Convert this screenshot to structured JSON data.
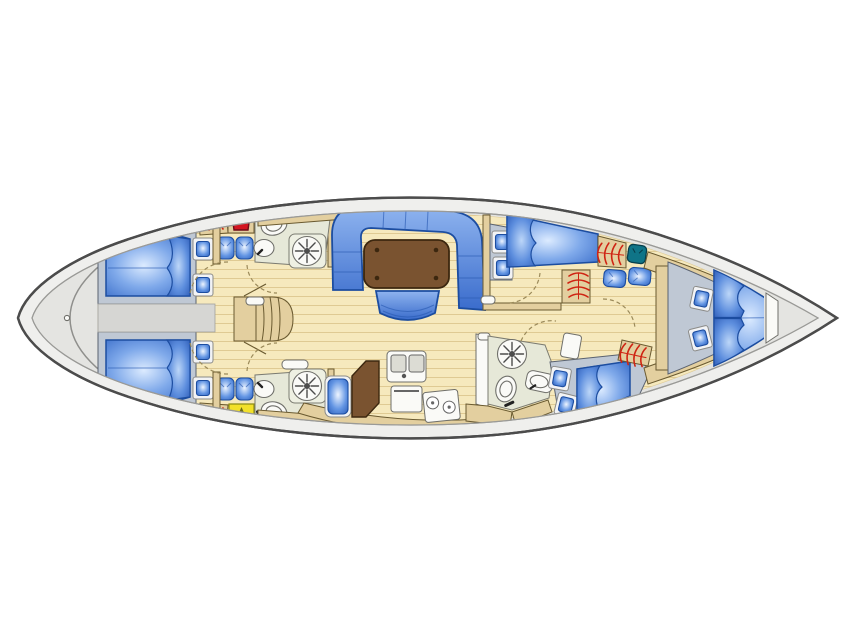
{
  "diagram": {
    "type": "sailing-yacht-interior-floor-plan",
    "orientation": {
      "bow": "right",
      "stern": "left",
      "port_side": "top",
      "starboard_side": "bottom"
    },
    "regions": [
      {
        "name": "transom"
      },
      {
        "name": "aft-cabin-port",
        "features": [
          "double-berth",
          "pillow",
          "hatch-windows",
          "seat-cushions",
          "hanging-locker",
          "wet-gear-locker"
        ]
      },
      {
        "name": "aft-cabin-starboard",
        "features": [
          "double-berth",
          "pillow",
          "hatch-windows",
          "seat-cushions",
          "hanging-locker",
          "yellow-arrow-locker"
        ]
      },
      {
        "name": "engine-compartment"
      },
      {
        "name": "companionway-stairs"
      },
      {
        "name": "head-aft-port",
        "features": [
          "toilet",
          "sink",
          "shower"
        ]
      },
      {
        "name": "head-aft-starboard",
        "features": [
          "toilet",
          "sink",
          "shower"
        ]
      },
      {
        "name": "salon",
        "features": [
          "u-shaped-settee",
          "dining-table",
          "stool"
        ]
      },
      {
        "name": "galley",
        "features": [
          "double-sink",
          "oven",
          "two-burner-stove",
          "fridge",
          "counter-seat"
        ]
      },
      {
        "name": "forward-cabin-port",
        "features": [
          "berth",
          "pillow",
          "hatch-windows",
          "hanging-lockers",
          "teal-seat",
          "seat-cushions"
        ]
      },
      {
        "name": "forward-cabin-starboard",
        "features": [
          "berth",
          "pillow",
          "hatch-windows",
          "hanging-locker"
        ]
      },
      {
        "name": "head-forward-starboard",
        "features": [
          "shower",
          "toilet",
          "sink"
        ]
      },
      {
        "name": "owner-cabin-bow",
        "features": [
          "v-berth",
          "two-pillows",
          "hatch-windows"
        ]
      },
      {
        "name": "bow-anchor-locker"
      }
    ],
    "icons": [
      {
        "name": "shower-fan-icon"
      },
      {
        "name": "toilet-icon"
      },
      {
        "name": "sink-icon"
      },
      {
        "name": "hanging-locker-icon"
      },
      {
        "name": "wet-jacket-icon"
      },
      {
        "name": "arrow-up-icon"
      },
      {
        "name": "hatch-window-icon"
      },
      {
        "name": "seat-cushion-icon"
      },
      {
        "name": "drain-circle-icon"
      }
    ],
    "colors": {
      "background": "#ffffff",
      "hull_stroke": "#4c4c4c",
      "deck": "#efefed",
      "deck_inner": "#e4e4e1",
      "deck_line": "#9a9a97",
      "floor": "#f6e9bd",
      "floor_line": "#dfca93",
      "wall": "#e3cf9f",
      "wall_stroke": "#6a5a30",
      "base_gray": "#bfc8d4",
      "base_stroke": "#5a6270",
      "corridor_gray": "#d6d6d3",
      "upholstery_stroke": "#1c4da0",
      "seam_blue": "#2a5ab2",
      "table_brown": "#7a5330",
      "table_stroke": "#3c270f",
      "head_room": "#e6e8d8",
      "fixture_white": "#fafaf7",
      "fixture_stroke": "#6f6f6a",
      "hanger_red": "#cf2413",
      "jacket_red": "#d31520",
      "jacket_stroke": "#6f0c18",
      "locker_yellow": "#f2e02a",
      "arrow_olive": "#6d6d17",
      "seat_teal": "#0f7487",
      "seat_teal_stroke": "#073f4c",
      "hatch_frame": "#f2f3f5",
      "door_dash": "#9b8a5a",
      "berth_hi": "#dcebff",
      "berth_mid": "#7fa9ea",
      "berth_lo": "#2e63c4",
      "pillow_hi": "#bcd6f8",
      "pillow_mid": "#5d8ede",
      "pillow_lo": "#2a58b4",
      "settee_hi": "#8fb4ef",
      "settee_lo": "#3a6ccc",
      "cushion_hi": "#eef5ff",
      "cushion_mid": "#6496e4",
      "cushion_lo": "#2a5cb8"
    }
  }
}
